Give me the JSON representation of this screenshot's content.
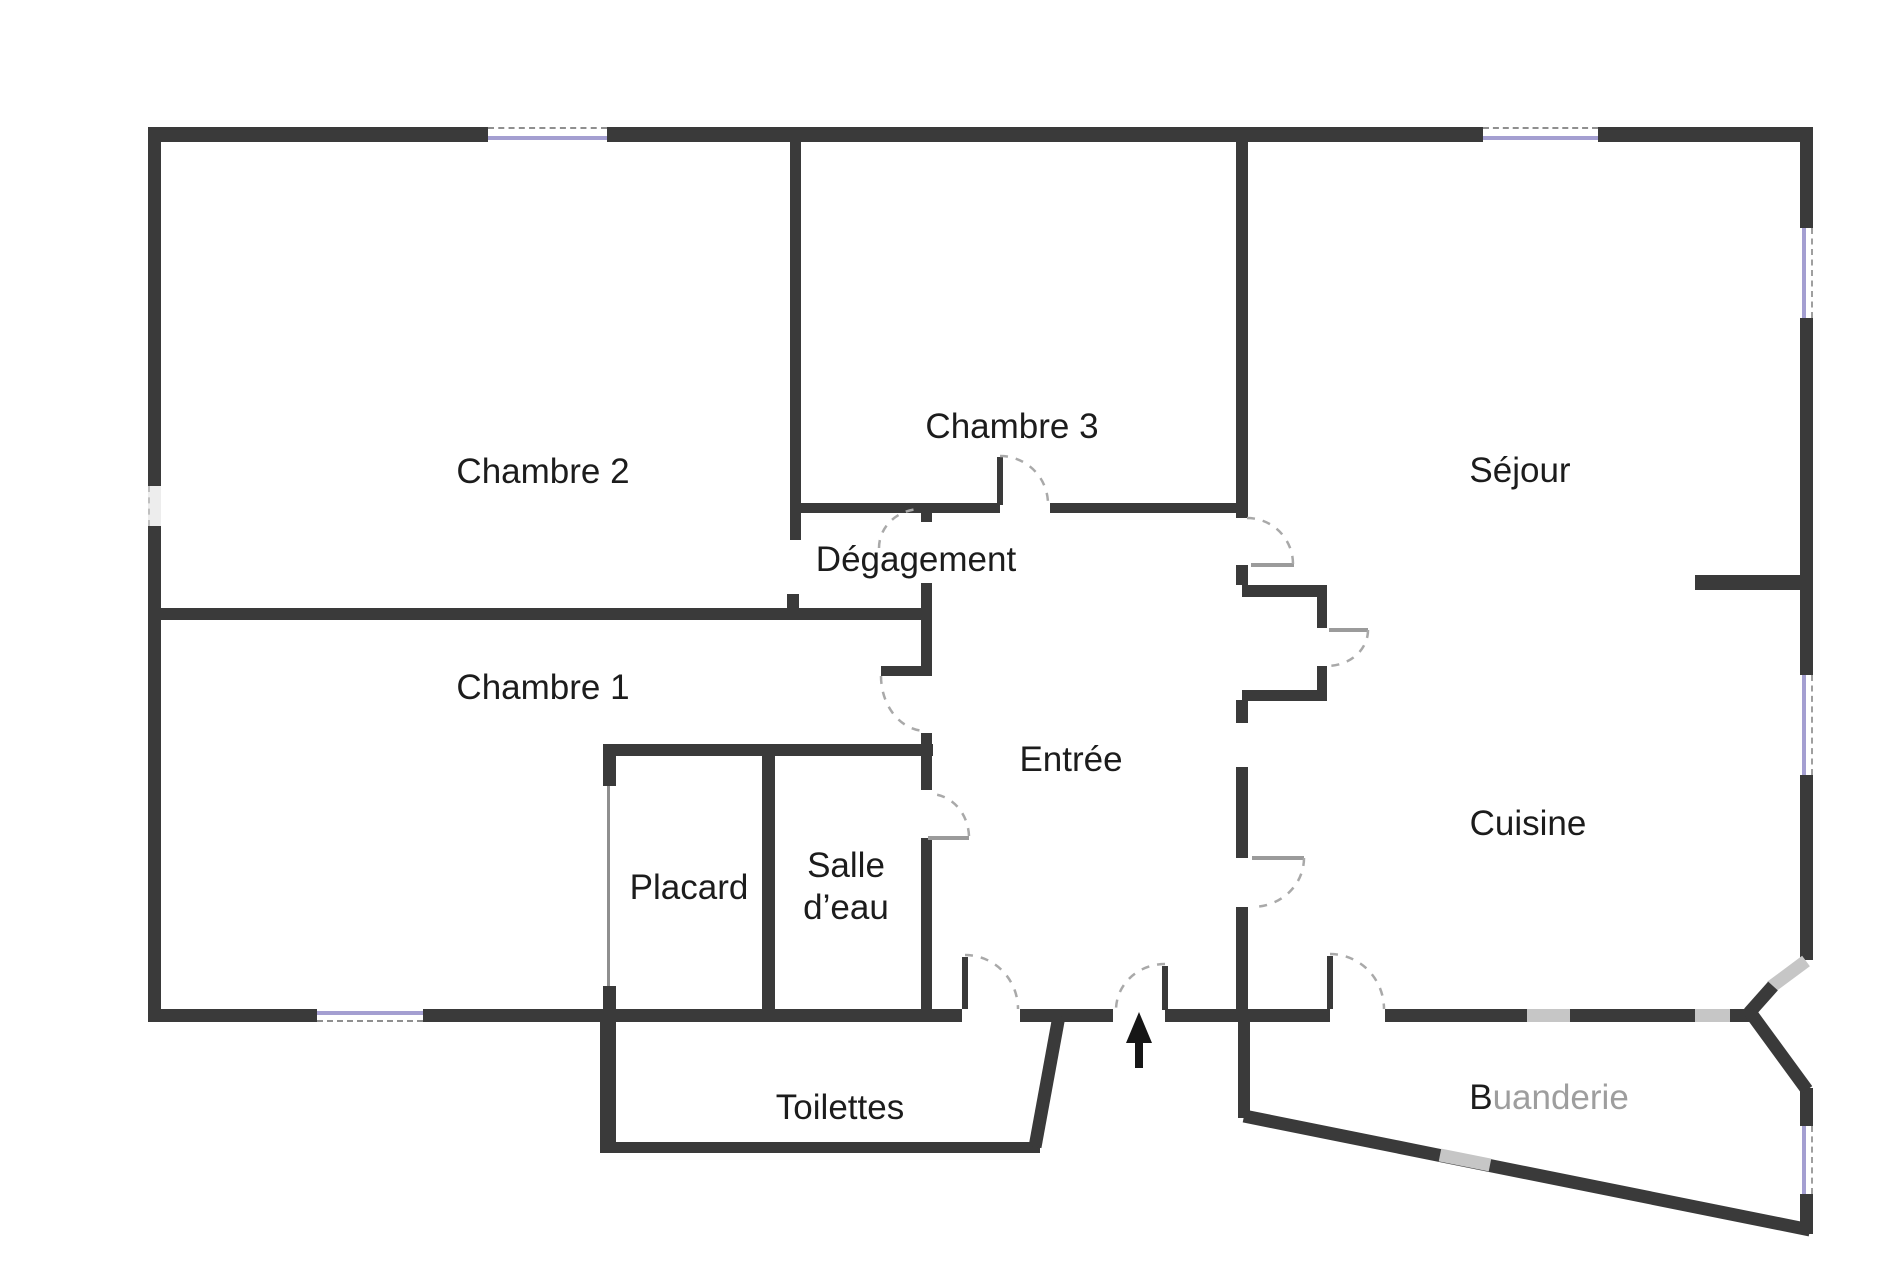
{
  "plan_type": "floor-plan",
  "colors": {
    "wall": "#3a3a3a",
    "wall_light": "#c6c6c6",
    "window": "#a49fd1",
    "door_arc": "#a9a9a9",
    "door_leaf": "#9b9b9b",
    "text": "#1c1c1c",
    "text_muted": "#9e9e9e",
    "background": "#ffffff"
  },
  "rooms": [
    {
      "id": "chambre-2",
      "label": "Chambre 2"
    },
    {
      "id": "chambre-3",
      "label": "Chambre 3"
    },
    {
      "id": "sejour",
      "label": "Séjour"
    },
    {
      "id": "degagement",
      "label": "Dégagement"
    },
    {
      "id": "chambre-1",
      "label": "Chambre 1"
    },
    {
      "id": "entree",
      "label": "Entrée"
    },
    {
      "id": "placard",
      "label": "Placard"
    },
    {
      "id": "salle-deau",
      "label_line1": "Salle",
      "label_line2": "d’eau"
    },
    {
      "id": "cuisine",
      "label": "Cuisine"
    },
    {
      "id": "toilettes",
      "label": "Toilettes"
    },
    {
      "id": "buanderie",
      "label_parts": [
        {
          "text": "B",
          "muted": false
        },
        {
          "text": "uanderie",
          "muted": true
        }
      ]
    }
  ],
  "icons": {
    "entrance_arrow": "up-arrow"
  }
}
